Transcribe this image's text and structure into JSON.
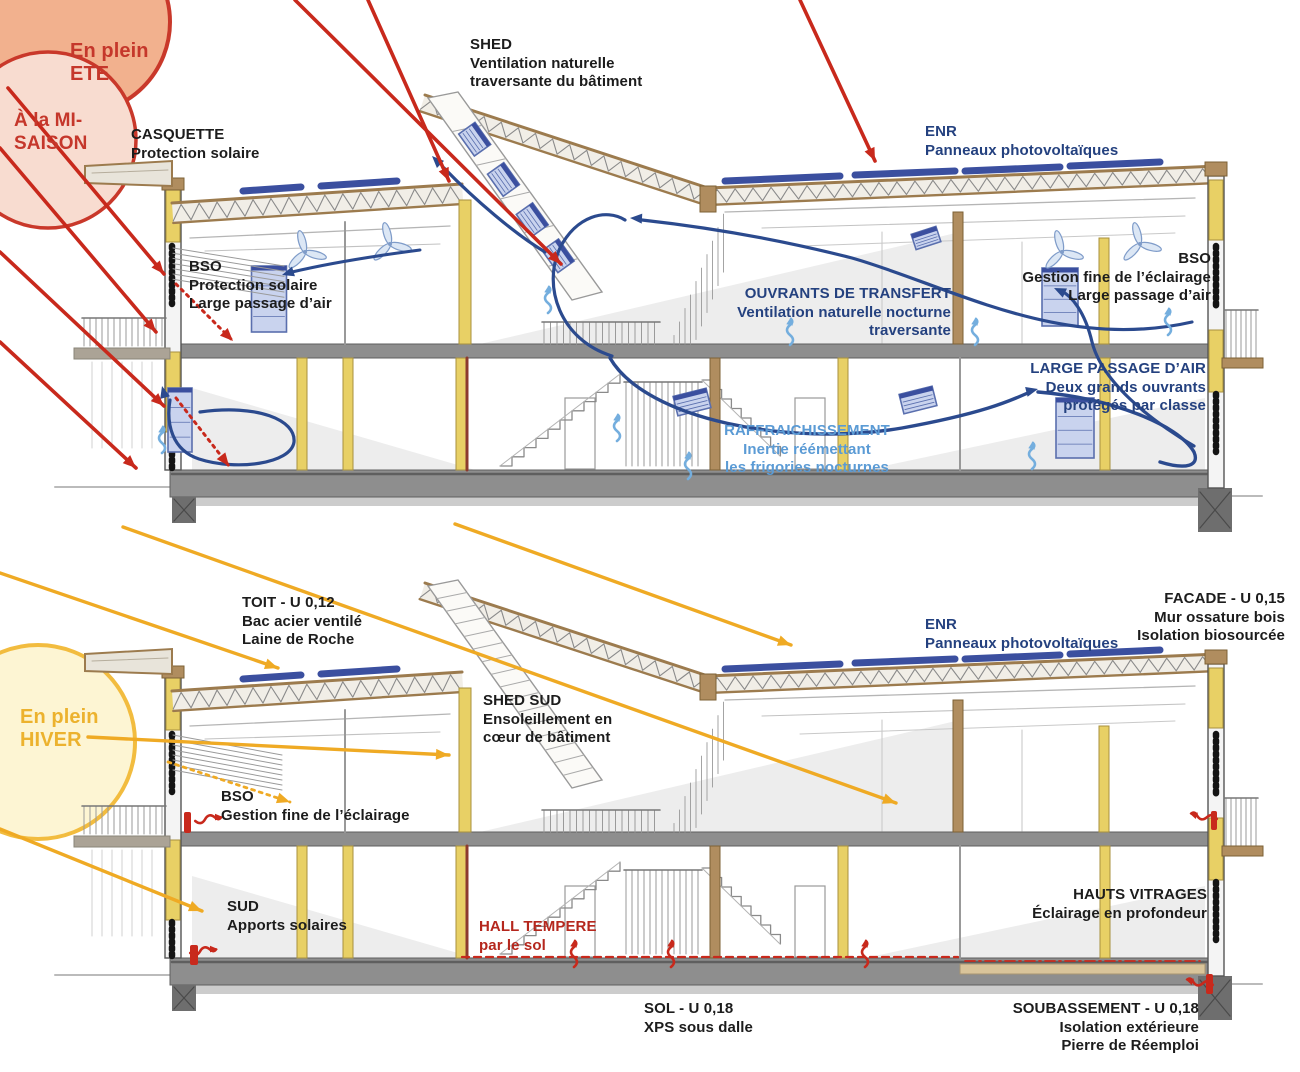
{
  "colors": {
    "red": "#c8291c",
    "red_text": "#b5271d",
    "sun_summer_fill": "#f2b18e",
    "sun_mid_fill": "#f8dcd0",
    "sun_winter_fill": "#fdf5d3",
    "yellow": "#f2bc3f",
    "yellow_arrow": "#efaa24",
    "navy_text": "#24417f",
    "navy_arrow": "#2b4a8e",
    "lightblue_text": "#5b9bd5",
    "cyan_arrow": "#74aede",
    "pv_panel": "#3b4f9f",
    "pane_fill": "#c9d3ee",
    "pane_stroke": "#5a6fae",
    "slab_gray": "#8e8e8e",
    "pier_gray": "#6e6e6e",
    "wood": "#9c7b4e",
    "wood_light": "#b08d5f",
    "insulation": "#e8d065",
    "insulation_edge": "#a8913e",
    "sketch": "#8a8a8a"
  },
  "summer": {
    "sun_summer": "En plein\nETE",
    "sun_midseason": "À la MI-\nSAISON",
    "labels": {
      "casquette": "CASQUETTE\nProtection solaire",
      "shed": "SHED\nVentilation naturelle\ntraversante du bâtiment",
      "enr": "ENR\nPanneaux photovoltaïques",
      "bso_left": "BSO\nProtection solaire\nLarge passage d’air",
      "ouvrants": "OUVRANTS DE TRANSFERT\nVentilation naturelle nocturne\ntraversante",
      "bso_right": "BSO\nGestion fine de l’éclairage\nLarge passage d’air",
      "large_passage": "LARGE PASSAGE D’AIR\nDeux grands ouvrants\nprotégés par classe",
      "raffraichissement": "RAFFRAICHISSEMENT\nInertie réémettant\nles frigories nocturnes"
    }
  },
  "winter": {
    "sun_winter": "En plein\nHIVER",
    "labels": {
      "toit": "TOIT - U 0,12\nBac acier ventilé\nLaine de Roche",
      "facade": "FACADE - U 0,15\nMur ossature bois\nIsolation biosourcée",
      "enr": "ENR\nPanneaux photovoltaïques",
      "shed_sud": "SHED SUD\nEnsoleillement en\ncœur de bâtiment",
      "bso": "BSO\nGestion fine de l’éclairage",
      "sud": "SUD\nApports solaires",
      "hall": "HALL TEMPERE\npar le sol",
      "hauts_vitrages": "HAUTS VITRAGES\nÉclairage en profondeur",
      "sol": "SOL - U 0,18\nXPS sous dalle",
      "soubassement": "SOUBASSEMENT - U 0,18\nIsolation extérieure\nPierre de Réemploi"
    }
  }
}
